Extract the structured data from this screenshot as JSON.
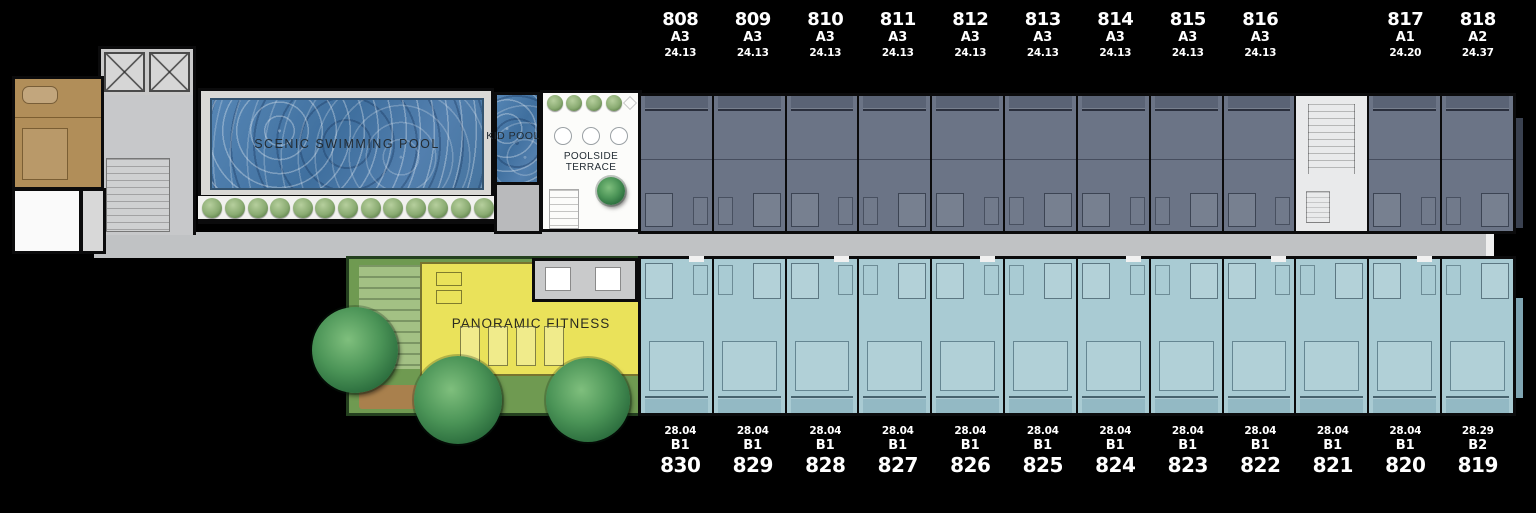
{
  "scene": {
    "type": "residential-floor-plan",
    "background_color": "#000000"
  },
  "amenities": {
    "swimming_pool_label": "SCENIC SWIMMING POOL",
    "kid_pool_label": "KID POOL",
    "poolside_terrace_label": "POOLSIDE TERRACE",
    "fitness_label": "PANORAMIC FITNESS"
  },
  "legend_colors": {
    "type_a_unit": "#6b7486",
    "type_b_unit": "#a9cbd3",
    "corridor": "#c0c2c4",
    "fitness_floor": "#eae25a",
    "garden": "#6f9a51",
    "pool_water": "#4f7fae",
    "large_unit": "#b18e59",
    "stair_core": "#e9eaeb",
    "label_text": "#ffffff"
  },
  "units_top": [
    {
      "number": "808",
      "type": "A3",
      "area": "24.13"
    },
    {
      "number": "809",
      "type": "A3",
      "area": "24.13"
    },
    {
      "number": "810",
      "type": "A3",
      "area": "24.13"
    },
    {
      "number": "811",
      "type": "A3",
      "area": "24.13"
    },
    {
      "number": "812",
      "type": "A3",
      "area": "24.13"
    },
    {
      "number": "813",
      "type": "A3",
      "area": "24.13"
    },
    {
      "number": "814",
      "type": "A3",
      "area": "24.13"
    },
    {
      "number": "815",
      "type": "A3",
      "area": "24.13"
    },
    {
      "number": "816",
      "type": "A3",
      "area": "24.13"
    },
    {
      "number": "817",
      "type": "A1",
      "area": "24.20"
    },
    {
      "number": "818",
      "type": "A2",
      "area": "24.37"
    }
  ],
  "units_bottom": [
    {
      "area": "28.04",
      "type": "B1",
      "number": "830"
    },
    {
      "area": "28.04",
      "type": "B1",
      "number": "829"
    },
    {
      "area": "28.04",
      "type": "B1",
      "number": "828"
    },
    {
      "area": "28.04",
      "type": "B1",
      "number": "827"
    },
    {
      "area": "28.04",
      "type": "B1",
      "number": "826"
    },
    {
      "area": "28.04",
      "type": "B1",
      "number": "825"
    },
    {
      "area": "28.04",
      "type": "B1",
      "number": "824"
    },
    {
      "area": "28.04",
      "type": "B1",
      "number": "823"
    },
    {
      "area": "28.04",
      "type": "B1",
      "number": "822"
    },
    {
      "area": "28.04",
      "type": "B1",
      "number": "821"
    },
    {
      "area": "28.04",
      "type": "B1",
      "number": "820"
    },
    {
      "area": "28.29",
      "type": "B2",
      "number": "819"
    }
  ]
}
